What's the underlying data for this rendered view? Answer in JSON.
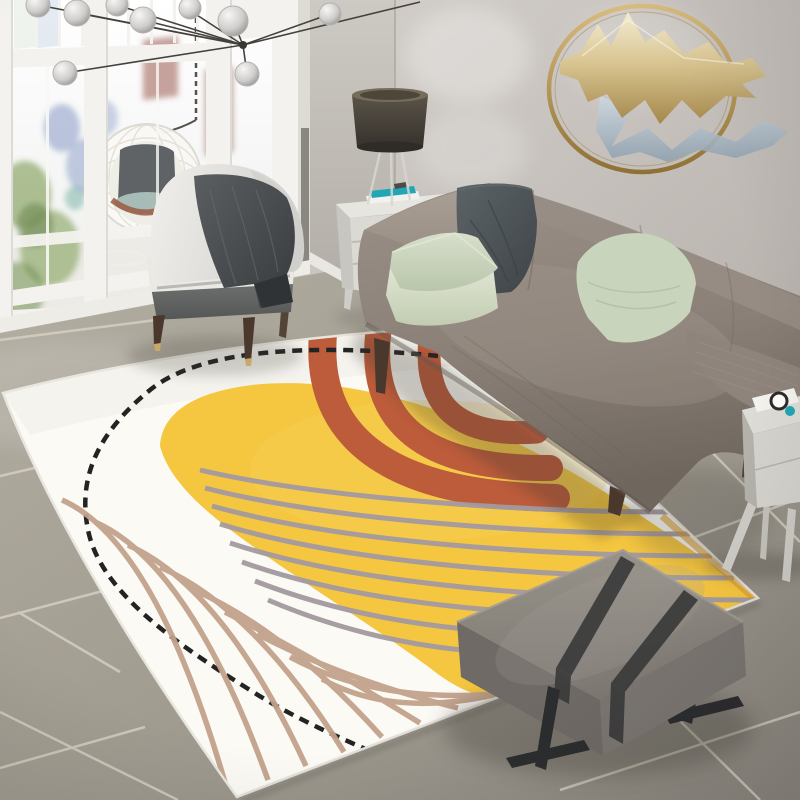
{
  "image": {
    "type": "photograph",
    "subject": "Modern living room with abstract cream-and-yellow area rug",
    "width_px": 800,
    "height_px": 800
  },
  "scene": {
    "room": "living room",
    "objects": [
      {
        "name": "window-wall",
        "desc": "white French doors and glass panes; balcony with hanging wicker egg chair and greenery outside"
      },
      {
        "name": "pendant-lights",
        "desc": "branching black-rod chandelier with mottled glass globes"
      },
      {
        "name": "wall-ring-art",
        "desc": "round gold metal ring wall sculpture with abstract gold and silver splash"
      },
      {
        "name": "table-lamp",
        "desc": "dark drum-shade lamp on clear tripod base"
      },
      {
        "name": "side-table",
        "desc": "white two-drawer side table with small books on top"
      },
      {
        "name": "accent-chair",
        "desc": "light gray slipper chair with charcoal throw blanket and wood legs"
      },
      {
        "name": "sofa",
        "desc": "taupe fabric sofa with wood cone legs"
      },
      {
        "name": "sofa-cushions",
        "desc": "one charcoal pillow and three sage green pillows"
      },
      {
        "name": "area-rug",
        "desc": "cream rug with yellow painted blob, terracotta brush arcs, black dashed oval and tan/gray contour lines"
      },
      {
        "name": "ottoman",
        "desc": "gray upholstered bench ottoman with two dark straps and black metal sled legs"
      },
      {
        "name": "nightstand",
        "desc": "white cabinet with splayed legs, white pad and teal accent on top"
      },
      {
        "name": "tile-floor",
        "desc": "large gray ceramic tiles with light grout"
      }
    ]
  },
  "colors": {
    "wall": "#c9c4bf",
    "wall-side": "#c3beb8",
    "window-frame": "#f3f2ee",
    "glass": "#fdfdfb",
    "floor": "#a49f93",
    "grout": "#d7d2c4",
    "rug-base": "#fbfaf5",
    "rug-yellow": "#f5c640",
    "rug-terracotta": "#bd5c3b",
    "rug-line-black": "#232323",
    "rug-line-tan": "#c2a28b",
    "rug-line-gray": "#a39aa0",
    "sofa": "#8d8279",
    "pillow-dark": "#4b5154",
    "pillow-sage": "#ccd6c0",
    "chair": "#e9e8e4",
    "chair-base": "#6b6e6c",
    "throw": "#45484a",
    "ottoman": "#847f7a",
    "strap": "#3b3b3b",
    "metal-leg": "#2c2d2f",
    "wood-leg": "#4a382c",
    "side-table": "#e7e5e0",
    "nightstand": "#dedcd7",
    "lamp-shade": "#4c473f",
    "gold": "#b6985e",
    "silver": "#b7c3cf",
    "brass": "#c9a96a",
    "teal-accent": "#21a6b6",
    "egg-chair-rim": "#9a5a44",
    "foliage": "#86a25e"
  }
}
